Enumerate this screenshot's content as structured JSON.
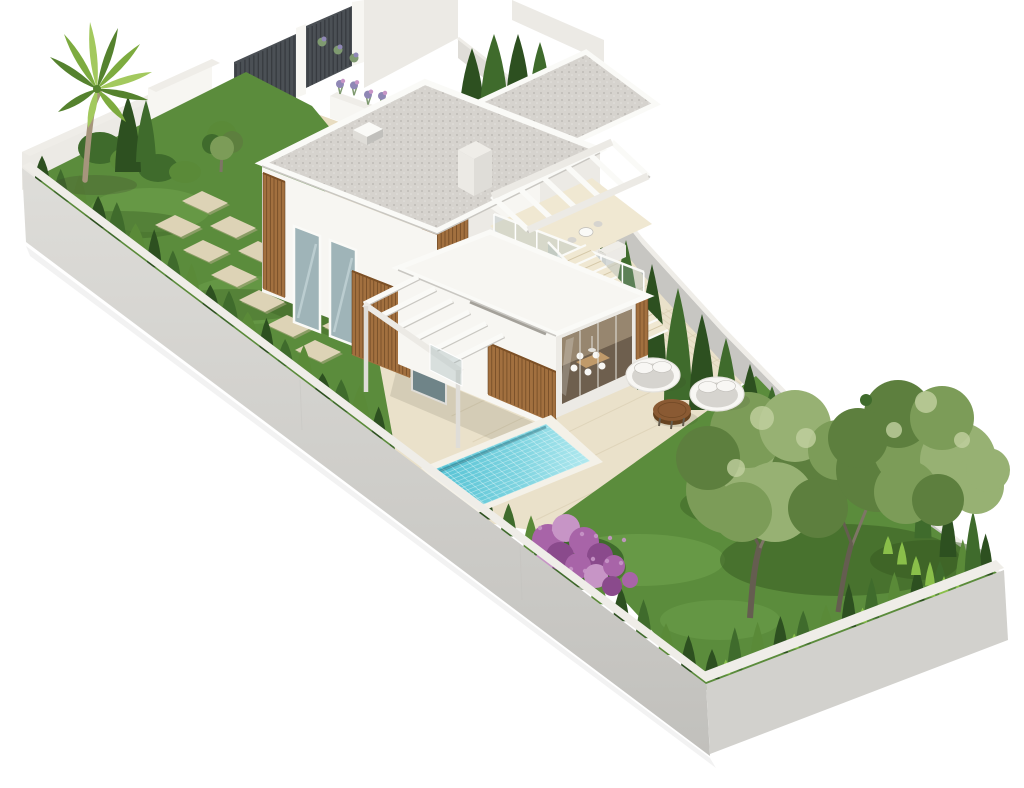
{
  "meta": {
    "type": "3d-architectural-render",
    "title": "Isometric 3D render of a walled villa plot",
    "canvas": {
      "width": 1024,
      "height": 788
    },
    "background": "#ffffff",
    "view": "isometric bird's-eye view from the south-west, plot runs diagonally from upper-left to lower-right on a white background"
  },
  "scene": {
    "description": "Photorealistic isometric render of a long rectangular walled plot containing a modern two-storey white villa with flat grey gravel roofs and wood-slat accents, a roof terrace with white pergola and glass balustrade, an exterior staircase, a covered glass dining terrace, a small rectangular turquoise swimming pool, a beige paved patio with two round white-framed daybeds and a round wooden coffee table, a west lawn with palm tree, cypress hedge and stepping-stone path leading to a rear gate with dark metal fence panels and a lavender planter, and an east lawn with two large olive trees, a purple flowering shrub and cypress hedges along all perimeter walls.",
    "objects": [
      "perimeter-wall",
      "rear-metal-fence",
      "entrance-gate",
      "garden-steps",
      "lavender-planter",
      "west-lawn",
      "palm-tree",
      "cypress-hedge",
      "stepping-stones",
      "garden-bushes",
      "small-tree",
      "waste-bin",
      "villa",
      "gravel-flat-roof",
      "skylight",
      "chimney",
      "wood-slat-cladding",
      "tall-windows",
      "roof-terrace",
      "glass-balustrade",
      "pergola",
      "exterior-staircase",
      "covered-dining-terrace",
      "dining-set",
      "swimming-pool",
      "paved-patio",
      "round-daybeds",
      "wooden-coffee-table",
      "east-lawn",
      "olive-trees",
      "purple-flowering-shrub",
      "terrace-ac-units"
    ]
  },
  "colors": {
    "background": "#ffffff",
    "wallCap": "#efede8",
    "wallFaceLight": "#deddd9",
    "wallFaceMid": "#d2d1cd",
    "wallFaceDark": "#c1c0bc",
    "wallInnerShade": "#c7c6c2",
    "fencePanel": "#4b5055",
    "fenceSlatLine": "#33373b",
    "gateDoor": "#5a5f64",
    "pavingPath": "#e8dcc0",
    "paving": "#eae1ca",
    "pavingLine": "#d6caad",
    "stepLight": "#f0e8d2",
    "stepMid": "#e2d7ba",
    "stepDark": "#d5c8a8",
    "stone": "#ddd3b6",
    "stoneShadow": "#b9ad8d",
    "lawn": "#5b8c3c",
    "lawnLight": "#74a650",
    "lawnDark": "#41682a",
    "lawnShadow": "#35571f",
    "hedgeDark": "#2d5020",
    "hedgeMid": "#3f6b2c",
    "hedgeLight": "#5a8a38",
    "hedgeBright": "#8abf4a",
    "treeGreen": "#7c9c58",
    "treeGreenLight": "#97b173",
    "treeGreenDark": "#5d7f3e",
    "treeHighlight": "#c2d1a0",
    "trunk": "#7e7566",
    "trunkDark": "#655d50",
    "palmGreen": "#7dab3f",
    "palmGreenDark": "#55822e",
    "palmGreenLight": "#a3c95e",
    "palmTrunk": "#a6957c",
    "houseWhite": "#f7f6f2",
    "houseShade": "#eceae5",
    "houseShade2": "#dfddd8",
    "fascia": "#fafaf7",
    "fasciaShadow": "#c9c7c2",
    "roofGravel": "#d6d3ce",
    "roofGravelDot": "#b7b4af",
    "roofGravelDot2": "#e4e2de",
    "wood": "#a2703f",
    "woodDark": "#7c5026",
    "woodLine": "#5f3c1c",
    "glass": "#9fb4b8",
    "glassLight": "#cfdee1",
    "glassDark": "#6f8488",
    "interiorDark": "#6e5f4e",
    "interiorWall": "#97866f",
    "tableTop": "#c09a6a",
    "furnitureWhite": "#f8f7f4",
    "furnitureFrame": "#e4e2dd",
    "cushion": "#d6d4cf",
    "cushionShade": "#bfbdb8",
    "tableWood": "#8a5a33",
    "tableWoodDark": "#66421f",
    "poolCoping": "#f4f1e8",
    "waterDeep": "#54c2d4",
    "waterMid": "#7fd4e0",
    "waterLight": "#b2e9ef",
    "waterLine": "#e6f8fa",
    "flowerPurple": "#a864a8",
    "flowerPurpleDark": "#8a4a8c",
    "flowerPurpleLight": "#c795c6",
    "lavender": "#8f87b5",
    "lavenderGreen": "#7f9a70",
    "acUnit": "#eceae6",
    "ventSlot": "#908d85",
    "shadow": "rgba(60,60,45,0.22)",
    "shadowSoft": "rgba(60,60,45,0.12)"
  }
}
